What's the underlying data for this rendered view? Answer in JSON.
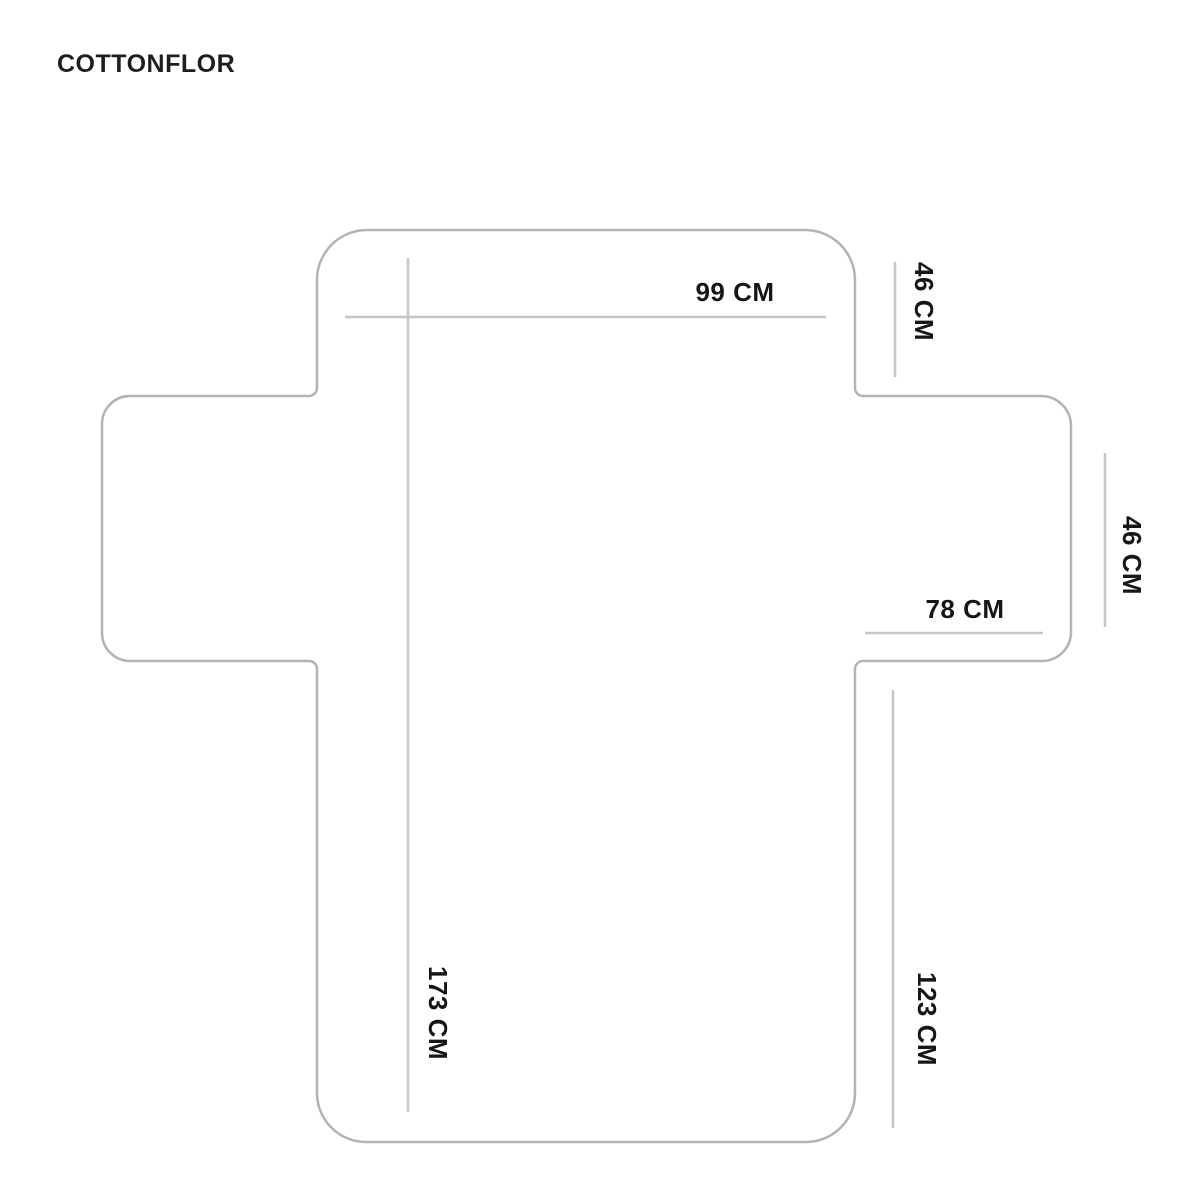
{
  "brand": "COTTONFLOR",
  "diagram": {
    "subject": "sofa-cover-flat-layout",
    "colors": {
      "background": "#ffffff",
      "outline": "#b3b3b3",
      "dimension_line": "#c6c6c6",
      "label_text": "#161616"
    },
    "dimensions": {
      "top_width": {
        "label": "99 CM",
        "value_cm": 99,
        "orientation": "horizontal"
      },
      "back_drop": {
        "label": "46 CM",
        "value_cm": 46,
        "orientation": "vertical"
      },
      "arm_drop": {
        "label": "46 CM",
        "value_cm": 46,
        "orientation": "vertical"
      },
      "seat_width": {
        "label": "78 CM",
        "value_cm": 78,
        "orientation": "horizontal"
      },
      "total_length": {
        "label": "173 CM",
        "value_cm": 173,
        "orientation": "vertical"
      },
      "side_length": {
        "label": "123 CM",
        "value_cm": 123,
        "orientation": "vertical"
      }
    }
  }
}
